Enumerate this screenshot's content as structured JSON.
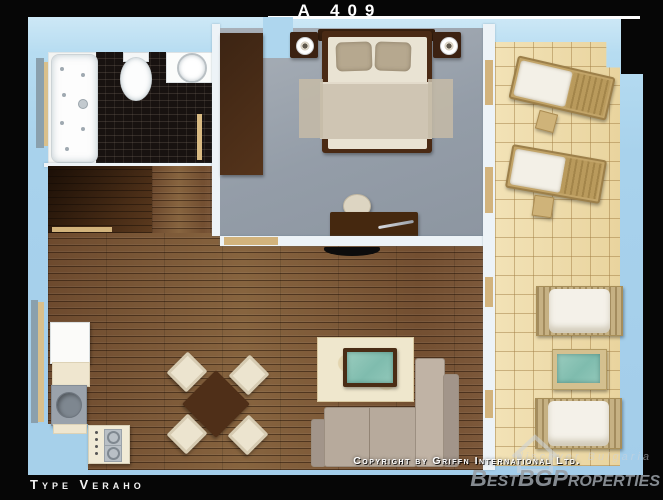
{
  "header": {
    "title": "A 409"
  },
  "footer": {
    "type_label": "Type Veraho",
    "copyright": "Copyright by Griffn International Ltd."
  },
  "watermark": {
    "brand": "BestBGProperties",
    "tagline": "discover Bulgaria",
    "icon": "house-outline-icon"
  },
  "palette": {
    "frame_black": "#060606",
    "background_blue": "#a8d2ec",
    "wood_floor": "#7c583a",
    "dark_wood": "#4a2b16",
    "bedroom_floor": "#99a2ac",
    "balcony_tile": "#eedaa8",
    "bathroom_tile": "#181210",
    "accent_teal": "#8cc4b6",
    "text_white": "#ffffff",
    "watermark_gray": "#969da4"
  }
}
